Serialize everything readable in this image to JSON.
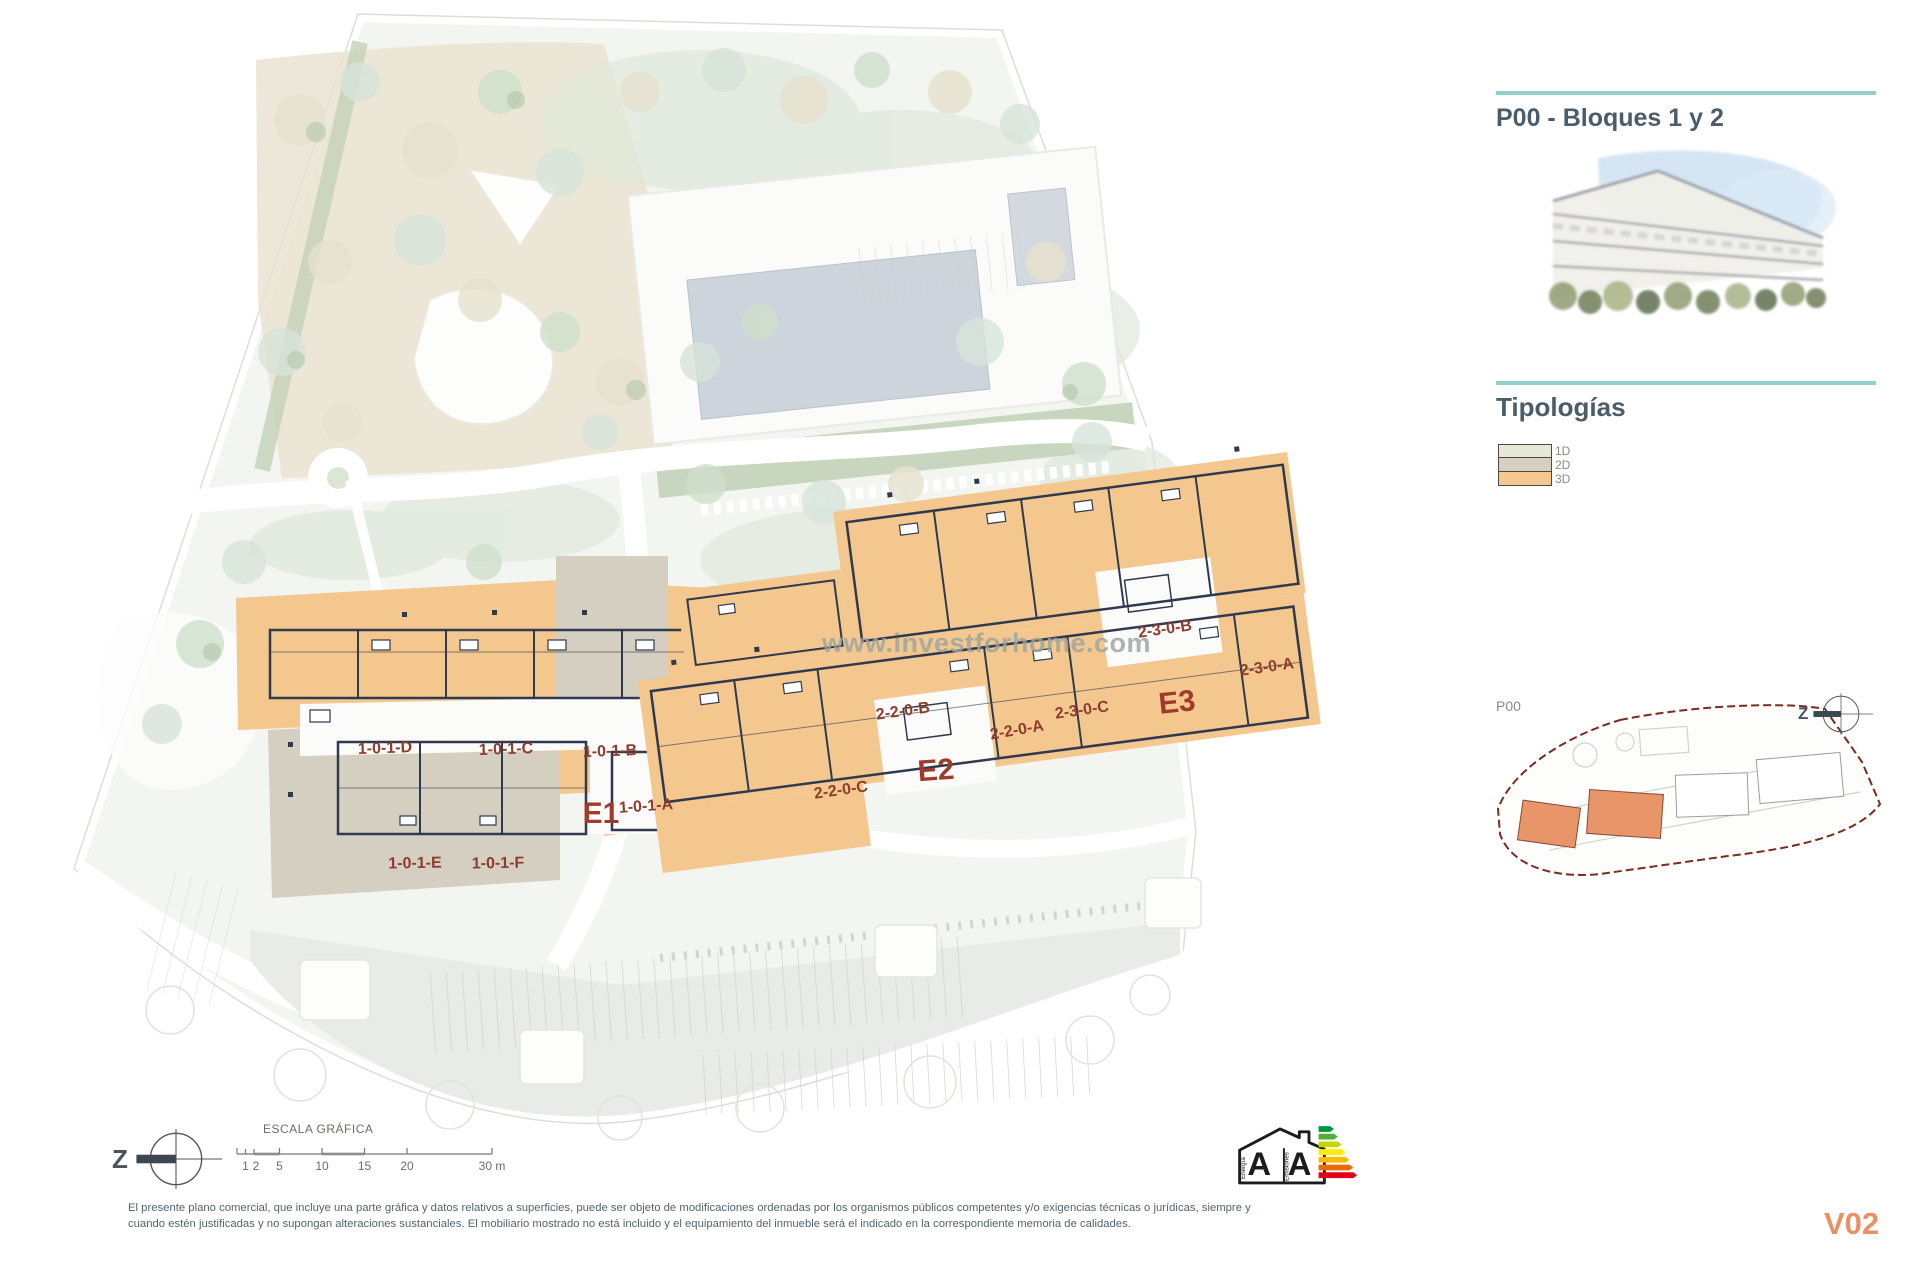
{
  "document": {
    "background": "#ffffff"
  },
  "right_panel": {
    "title": "P00 - Bloques 1 y 2",
    "accent_rule_color": "#8ed2cb",
    "heading_color": "#4b5c6b",
    "typologies_title": "Tipologías",
    "legend": [
      {
        "label": "1D",
        "color": "#e8e7d8"
      },
      {
        "label": "2D",
        "color": "#d6d0c3"
      },
      {
        "label": "3D",
        "color": "#f4c88e"
      }
    ],
    "minimap": {
      "plan_label": "P00",
      "compass_letter": "Z",
      "boundary_color": "#7d2b1f",
      "highlight_color": "#e8956a"
    }
  },
  "plan": {
    "watermark": "www.investforhome.com",
    "unit_label_color": "#8f3c2f",
    "typology_orange": "#f3c78e",
    "typology_gray": "#d5cfc2",
    "wall_color": "#303a4e",
    "labels": [
      {
        "text": "1-0-1-D"
      },
      {
        "text": "1-0-1-C"
      },
      {
        "text": "1-0-1-B"
      },
      {
        "text": "1-0-1-A"
      },
      {
        "text": "1-0-1-E"
      },
      {
        "text": "1-0-1-F"
      },
      {
        "text": "2-2-0-C"
      },
      {
        "text": "2-2-0-B"
      },
      {
        "text": "2-2-0-A"
      },
      {
        "text": "2-3-0-C"
      },
      {
        "text": "2-3-0-B"
      },
      {
        "text": "2-3-0-A"
      }
    ],
    "block_labels": [
      {
        "text": "E1"
      },
      {
        "text": "E2"
      },
      {
        "text": "E3"
      }
    ]
  },
  "footer": {
    "compass_letter": "Z",
    "scale_title": "ESCALA GRÁFICA",
    "scale_ticks": [
      "1",
      "2",
      "5",
      "10",
      "15",
      "20",
      "30 m"
    ],
    "disclaimer_line1": "El presente plano comercial, que incluye una parte gráfica y datos relativos a superficies, puede ser objeto de modificaciones ordenadas por los organismos públicos competentes y/o exigencias técnicas o jurídicas, siempre y",
    "disclaimer_line2": "cuando estén justificadas y no supongan alteraciones sustanciales. El mobiliario mostrado no está incluido y el equipamiento del inmueble será el indicado en la correspondiente memoria de calidades.",
    "version": "V02",
    "version_color": "#ec8f66"
  },
  "energy_label": {
    "energy_letter": "A",
    "emissions_letter": "A",
    "energy_text": "Energía",
    "emissions_text": "Emisiones",
    "arrow_colors": [
      "#00963f",
      "#52ae34",
      "#c3d600",
      "#ffec00",
      "#faba00",
      "#eb6909",
      "#e2001a"
    ]
  }
}
